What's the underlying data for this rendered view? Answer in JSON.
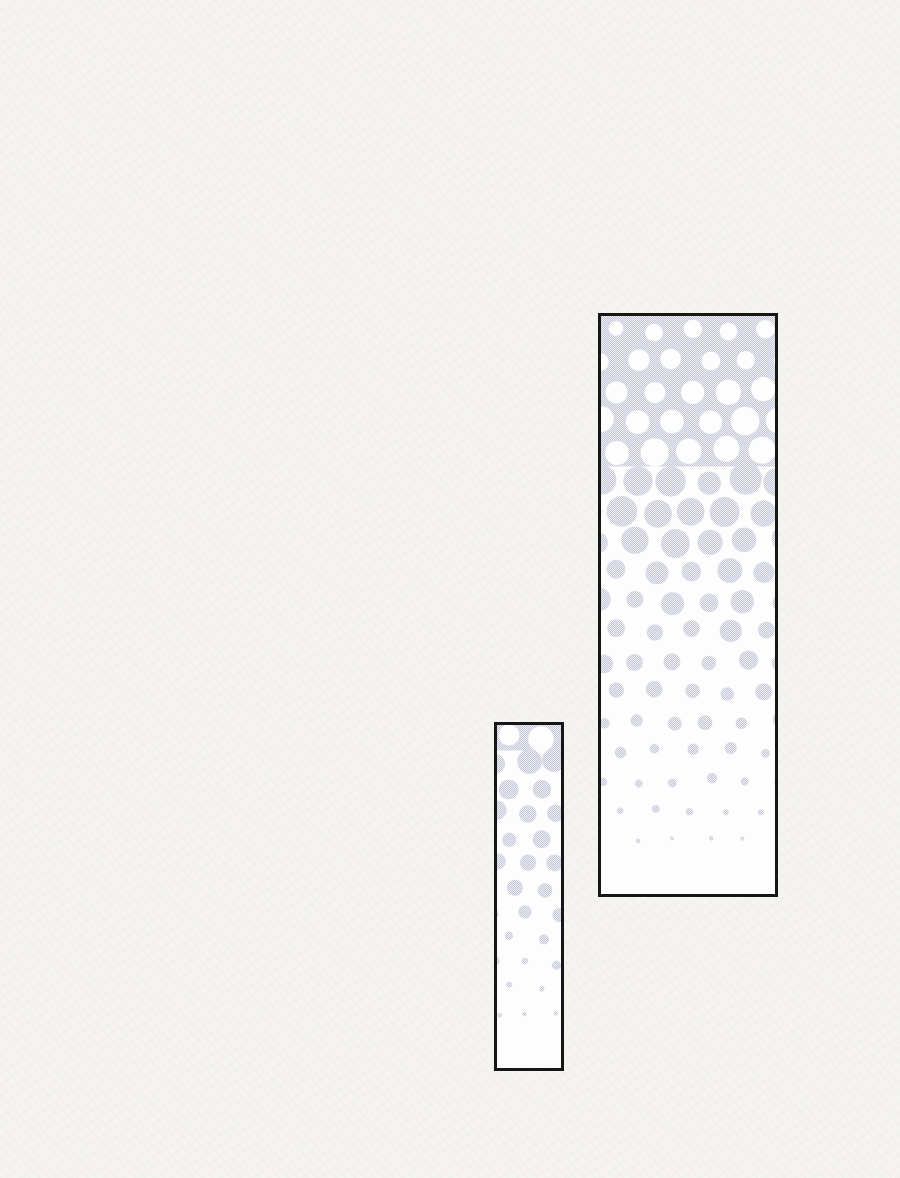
{
  "page": {
    "width": 900,
    "height": 1178,
    "background": "#f5f4f0",
    "description": "Blank comic (manhwa) page region containing two empty vertical panels filled with a halftone screentone gradient, no text"
  },
  "colors": {
    "paper": "#f5f4f0",
    "panel_border": "#161616",
    "panel_fill": "#fdfdfe",
    "tone_light": "#efeff6",
    "tone_dark": "#c4c4d7"
  },
  "panels": [
    {
      "id": "large",
      "name": "comic-panel-large",
      "x": 598,
      "y": 313,
      "outer_w": 180,
      "outer_h": 584,
      "border_px": 3,
      "cell": 36,
      "row_step": 30,
      "cov_top": 0.88,
      "cov_exp": 1.8,
      "tone_description": "halftone gradient: dense lavender screentone with small white dots at top, dots enlarge and merge mid-panel, inverts to shrinking lavender dots fading to white at bottom"
    },
    {
      "id": "small",
      "name": "comic-panel-small",
      "x": 494,
      "y": 722,
      "outer_w": 70,
      "outer_h": 349,
      "border_px": 3,
      "cell": 30,
      "row_step": 25,
      "cov_top": 0.55,
      "cov_exp": 1.9,
      "tone_description": "halftone gradient: partially merged lavender tone blobs at top dissolving into small dots fading to white at bottom"
    }
  ]
}
